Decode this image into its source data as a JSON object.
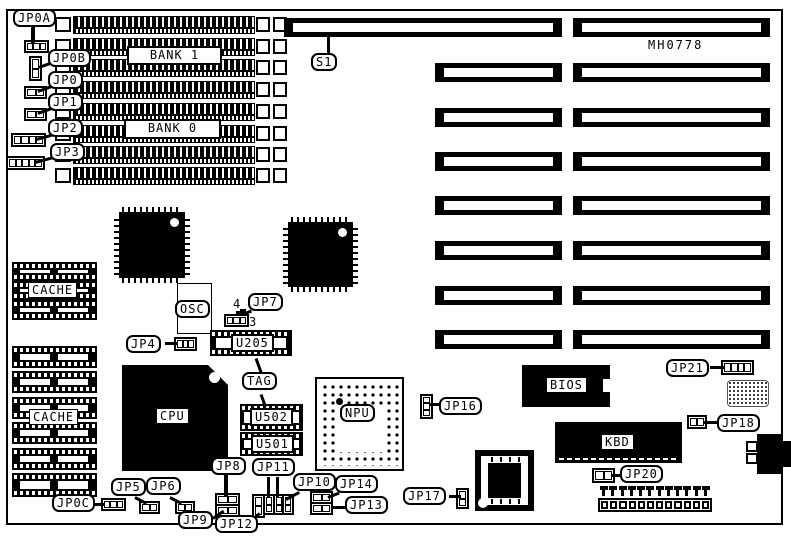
{
  "board": {
    "part_number": "MH0778",
    "memory_banks": {
      "bank1": "BANK 1",
      "bank0": "BANK 0"
    },
    "slot_switch": "S1",
    "cache": {
      "upper": "CACHE",
      "lower": "CACHE"
    },
    "chips": {
      "cpu": "CPU",
      "npu": "NPU",
      "bios": "BIOS",
      "kbd": "KBD",
      "osc": "OSC",
      "u205": "U205",
      "u502": "U502",
      "u501": "U501",
      "tag": "TAG"
    },
    "jumpers": {
      "jp0a": "JP0A",
      "jp0b": "JP0B",
      "jp0": "JP0",
      "jp1": "JP1",
      "jp2": "JP2",
      "jp3": "JP3",
      "jp0c": "JP0C",
      "jp4": "JP4",
      "jp5": "JP5",
      "jp6": "JP6",
      "jp7": "JP7",
      "jp8": "JP8",
      "jp9": "JP9",
      "jp10": "JP10",
      "jp11": "JP11",
      "jp12": "JP12",
      "jp13": "JP13",
      "jp14": "JP14",
      "jp16": "JP16",
      "jp17": "JP17",
      "jp18": "JP18",
      "jp20": "JP20",
      "jp21": "JP21"
    },
    "jp7_pins": {
      "top": "4",
      "bottom": "3"
    }
  }
}
